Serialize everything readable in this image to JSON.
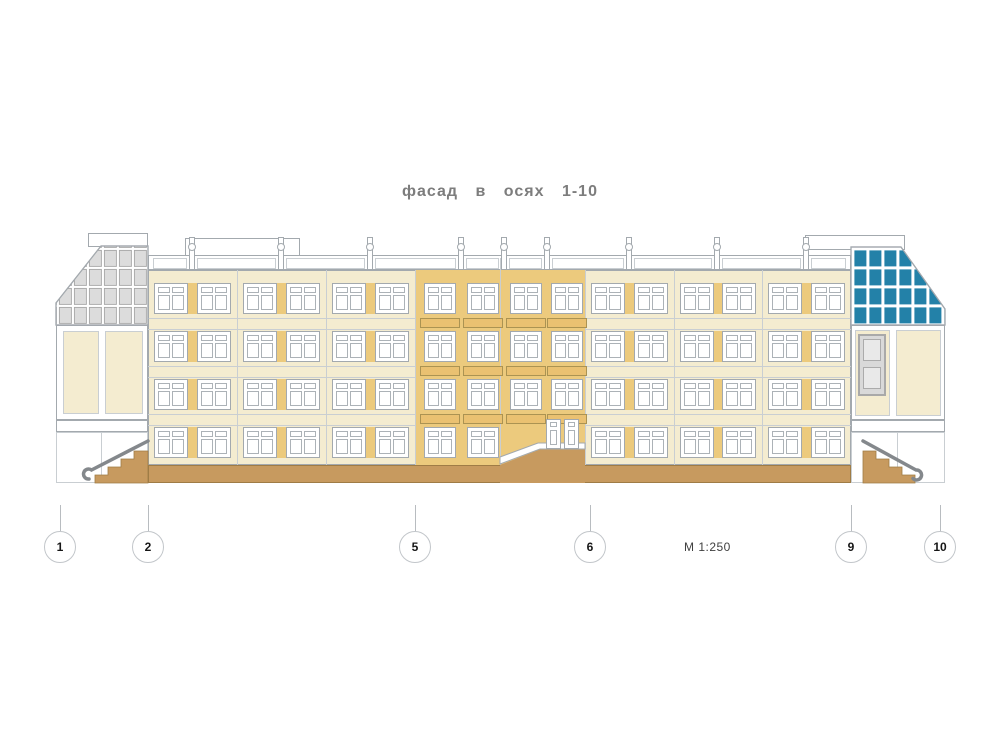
{
  "title": "фасад в осях 1-10",
  "scale_label": "М 1:250",
  "axes": [
    "1",
    "2",
    "5",
    "6",
    "9",
    "10"
  ],
  "colors": {
    "wall_cream": "#F4ECD0",
    "accent_tan": "#ECCA7D",
    "spandrel_tan": "#EAC171",
    "base_brown": "#C79A5F",
    "glass_grey": "#DCDCDC",
    "glass_blue": "#2381A8",
    "line_grey": "#A3A9AE",
    "light_line": "#C9CED2",
    "rail_grey": "#84888C",
    "title_grey": "#7D7D7D"
  }
}
